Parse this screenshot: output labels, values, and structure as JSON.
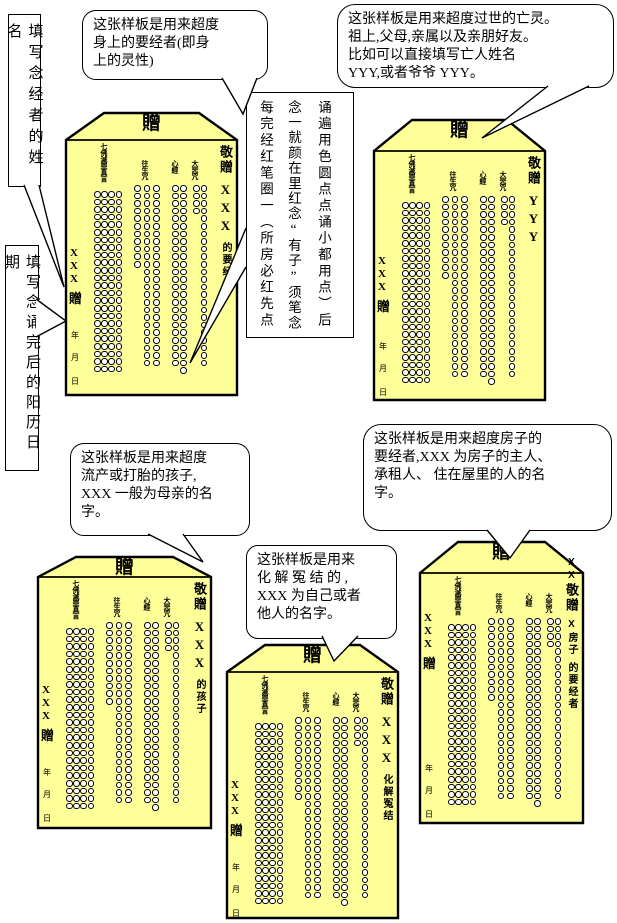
{
  "colors": {
    "envelope_fill": "#FFFF99",
    "ink": "#000000",
    "circle_fill": "#FFFFFF"
  },
  "notes": {
    "chanter_name": "填写念经者的姓名",
    "completion_date": "填写念诵完后的阳历日期"
  },
  "callouts": {
    "body_spirits": {
      "lines": [
        "这张样板是用来超度",
        "身上的要经者(即身",
        "上的灵性)"
      ]
    },
    "deceased": {
      "lines": [
        "这张样板是用来超度过世的亡灵。",
        "祖上,父母,亲属以及亲朋好友。",
        "比如可以直接填写亡人姓名",
        "YYY,或者爷爷 YYY。"
      ]
    },
    "children": {
      "lines": [
        "这张样板是用来超度",
        "流产或打胎的孩子,",
        "XXX 一般为母亲的名",
        "字。"
      ]
    },
    "house": {
      "lines": [
        "这张样板是用来超度房子的",
        "要经者,XXX 为房子的主人、",
        "承租人、 住在屋里的人的名",
        "字。"
      ]
    },
    "conflict": {
      "lines": [
        "这张样板是用来",
        "化 解 冤 结 的 ,",
        "XXX 为自己或者",
        "他人的名字。"
      ]
    }
  },
  "instruction_box": {
    "columns_left_to_right": [
      "每完经红笔圈一︵所房必红先点",
      "念一就颜在里红念“有子”须笔念",
      "诵遍用色圆点点诵小都用点︶后"
    ]
  },
  "envelope_common": {
    "roof_char": "贈",
    "presenter": "敬贈",
    "chanter_placeholder": "XXX",
    "give_char": "贈",
    "date_chars": [
      "年",
      "月",
      "日"
    ],
    "mantra_groups": [
      {
        "label": "七佛滅罪真言",
        "column_rows": [
          24,
          24,
          24,
          24
        ]
      },
      {
        "label": "往生咒",
        "column_rows": [
          11,
          24,
          24
        ]
      },
      {
        "label": "心經",
        "column_rows": [
          24,
          25
        ]
      },
      {
        "label": "大悲咒",
        "column_rows": [
          4,
          24
        ]
      }
    ]
  },
  "envelopes": [
    {
      "key": "body-spirits",
      "recipient_top": null,
      "recipient": [
        "XXX",
        "的要经者"
      ]
    },
    {
      "key": "deceased",
      "recipient_top": null,
      "recipient": [
        "YYY"
      ]
    },
    {
      "key": "children",
      "recipient_top": null,
      "recipient": [
        "XXX",
        "的孩子"
      ]
    },
    {
      "key": "conflict",
      "recipient_top": null,
      "recipient": [
        "XXX",
        "化解冤结"
      ]
    },
    {
      "key": "house",
      "recipient_top": "XX",
      "recipient": [
        "X房子",
        "的要经者"
      ]
    }
  ]
}
